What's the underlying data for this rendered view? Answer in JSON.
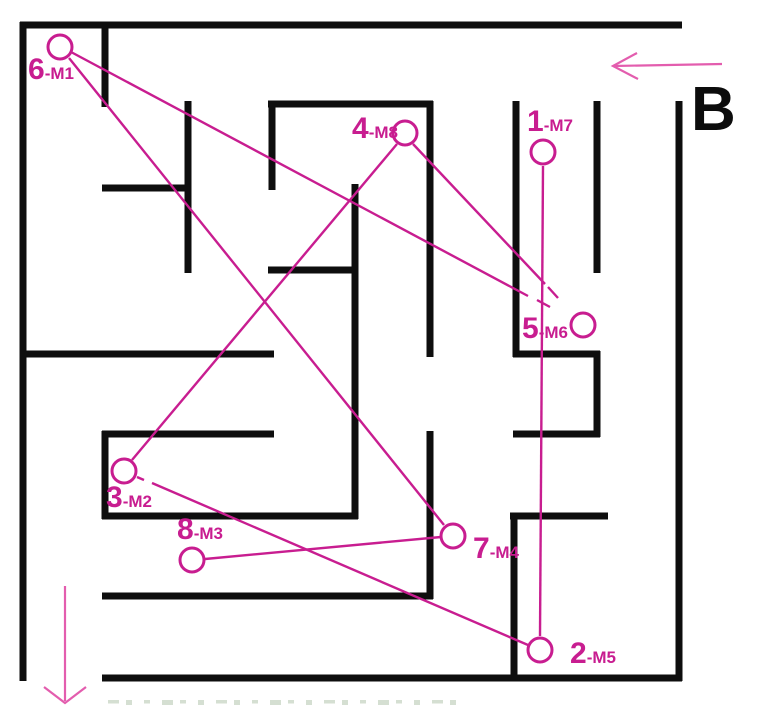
{
  "figure": {
    "background": "#ffffff",
    "wall_color": "#0e0e0e",
    "wall_thickness": 7,
    "path_color": "#c81d90",
    "arrow_color": "#e35dae",
    "entry_label": "B",
    "entry_label_pos": {
      "x": 691,
      "y": 130
    },
    "walls": {
      "horizontal": [
        {
          "x1": 20,
          "x2": 682,
          "y": 25
        },
        {
          "x1": 268,
          "x2": 433,
          "y": 104
        },
        {
          "x1": 102,
          "x2": 191,
          "y": 188
        },
        {
          "x1": 268,
          "x2": 358,
          "y": 270
        },
        {
          "x1": 20,
          "x2": 274,
          "y": 354
        },
        {
          "x1": 513,
          "x2": 600,
          "y": 354
        },
        {
          "x1": 102,
          "x2": 274,
          "y": 434
        },
        {
          "x1": 513,
          "x2": 600,
          "y": 434
        },
        {
          "x1": 102,
          "x2": 358,
          "y": 516
        },
        {
          "x1": 510,
          "x2": 608,
          "y": 516
        },
        {
          "x1": 102,
          "x2": 433,
          "y": 596
        },
        {
          "x1": 102,
          "x2": 682,
          "y": 678
        }
      ],
      "vertical": [
        {
          "x": 23,
          "y1": 22,
          "y2": 681
        },
        {
          "x": 679,
          "y1": 101,
          "y2": 681
        },
        {
          "x": 105,
          "y1": 25,
          "y2": 107
        },
        {
          "x": 105,
          "y1": 431,
          "y2": 519
        },
        {
          "x": 188,
          "y1": 101,
          "y2": 273
        },
        {
          "x": 272,
          "y1": 101,
          "y2": 190
        },
        {
          "x": 355,
          "y1": 184,
          "y2": 519
        },
        {
          "x": 430,
          "y1": 101,
          "y2": 357
        },
        {
          "x": 430,
          "y1": 431,
          "y2": 599
        },
        {
          "x": 516,
          "y1": 101,
          "y2": 357
        },
        {
          "x": 514,
          "y1": 513,
          "y2": 681
        },
        {
          "x": 597,
          "y1": 101,
          "y2": 273
        },
        {
          "x": 597,
          "y1": 351,
          "y2": 437
        }
      ]
    },
    "markers": [
      {
        "id": "1-M7",
        "num": "1",
        "suffix": "-M7",
        "cx": 543,
        "cy": 152,
        "label_x": 527,
        "label_y": 131
      },
      {
        "id": "2-M5",
        "num": "2",
        "suffix": "-M5",
        "cx": 540,
        "cy": 650,
        "label_x": 570,
        "label_y": 663
      },
      {
        "id": "3-M2",
        "num": "3",
        "suffix": "-M2",
        "cx": 124,
        "cy": 471,
        "label_x": 106,
        "label_y": 507
      },
      {
        "id": "4-M8",
        "num": "4",
        "suffix": "-M8",
        "cx": 405,
        "cy": 133,
        "label_x": 352,
        "label_y": 138
      },
      {
        "id": "5-M6",
        "num": "5",
        "suffix": "-M6",
        "cx": 583,
        "cy": 325,
        "label_x": 522,
        "label_y": 338
      },
      {
        "id": "6-M1",
        "num": "6",
        "suffix": "-M1",
        "cx": 60,
        "cy": 47,
        "label_x": 28,
        "label_y": 79
      },
      {
        "id": "7-M4",
        "num": "7",
        "suffix": "-M4",
        "cx": 453,
        "cy": 536,
        "label_x": 473,
        "label_y": 558
      },
      {
        "id": "8-M3",
        "num": "8",
        "suffix": "-M3",
        "cx": 192,
        "cy": 560,
        "label_x": 177,
        "label_y": 539
      }
    ],
    "marker_radius": 12,
    "connections": [
      {
        "from": "1-M7",
        "to": "2-M5",
        "segments": [
          [
            543,
            166,
            540,
            636
          ]
        ]
      },
      {
        "from": "2-M5",
        "to": "3-M2",
        "segments": [
          [
            528,
            645,
            152,
            483
          ],
          [
            144,
            480,
            137,
            477
          ]
        ]
      },
      {
        "from": "3-M2",
        "to": "4-M8",
        "segments": [
          [
            132,
            460,
            397,
            144
          ]
        ]
      },
      {
        "from": "4-M8",
        "to": "5-M6",
        "segments": [
          [
            413,
            144,
            545,
            284
          ],
          [
            548,
            287,
            558,
            298
          ]
        ]
      },
      {
        "from": "5-M6",
        "to": "6-M1",
        "segments": [
          [
            71,
            52,
            528,
            296
          ],
          [
            537,
            300,
            550,
            307
          ]
        ]
      },
      {
        "from": "6-M1",
        "to": "7-M4",
        "segments": [
          [
            69,
            58,
            444,
            525
          ]
        ]
      },
      {
        "from": "7-M4",
        "to": "8-M3",
        "segments": [
          [
            441,
            537,
            205,
            559
          ]
        ]
      }
    ],
    "entry_arrow": {
      "shaft": [
        613,
        66,
        722,
        64
      ],
      "head": [
        [
          637,
          53
        ],
        [
          613,
          66
        ],
        [
          638,
          79
        ]
      ]
    },
    "exit_arrow": {
      "shaft": [
        65,
        586,
        65,
        701
      ],
      "head": [
        [
          44,
          687
        ],
        [
          65,
          703
        ],
        [
          86,
          687
        ]
      ]
    },
    "caption_fragment": {
      "visible": true,
      "x1": 108,
      "x2": 455,
      "y": 700,
      "color": "#c7d4c3"
    }
  }
}
